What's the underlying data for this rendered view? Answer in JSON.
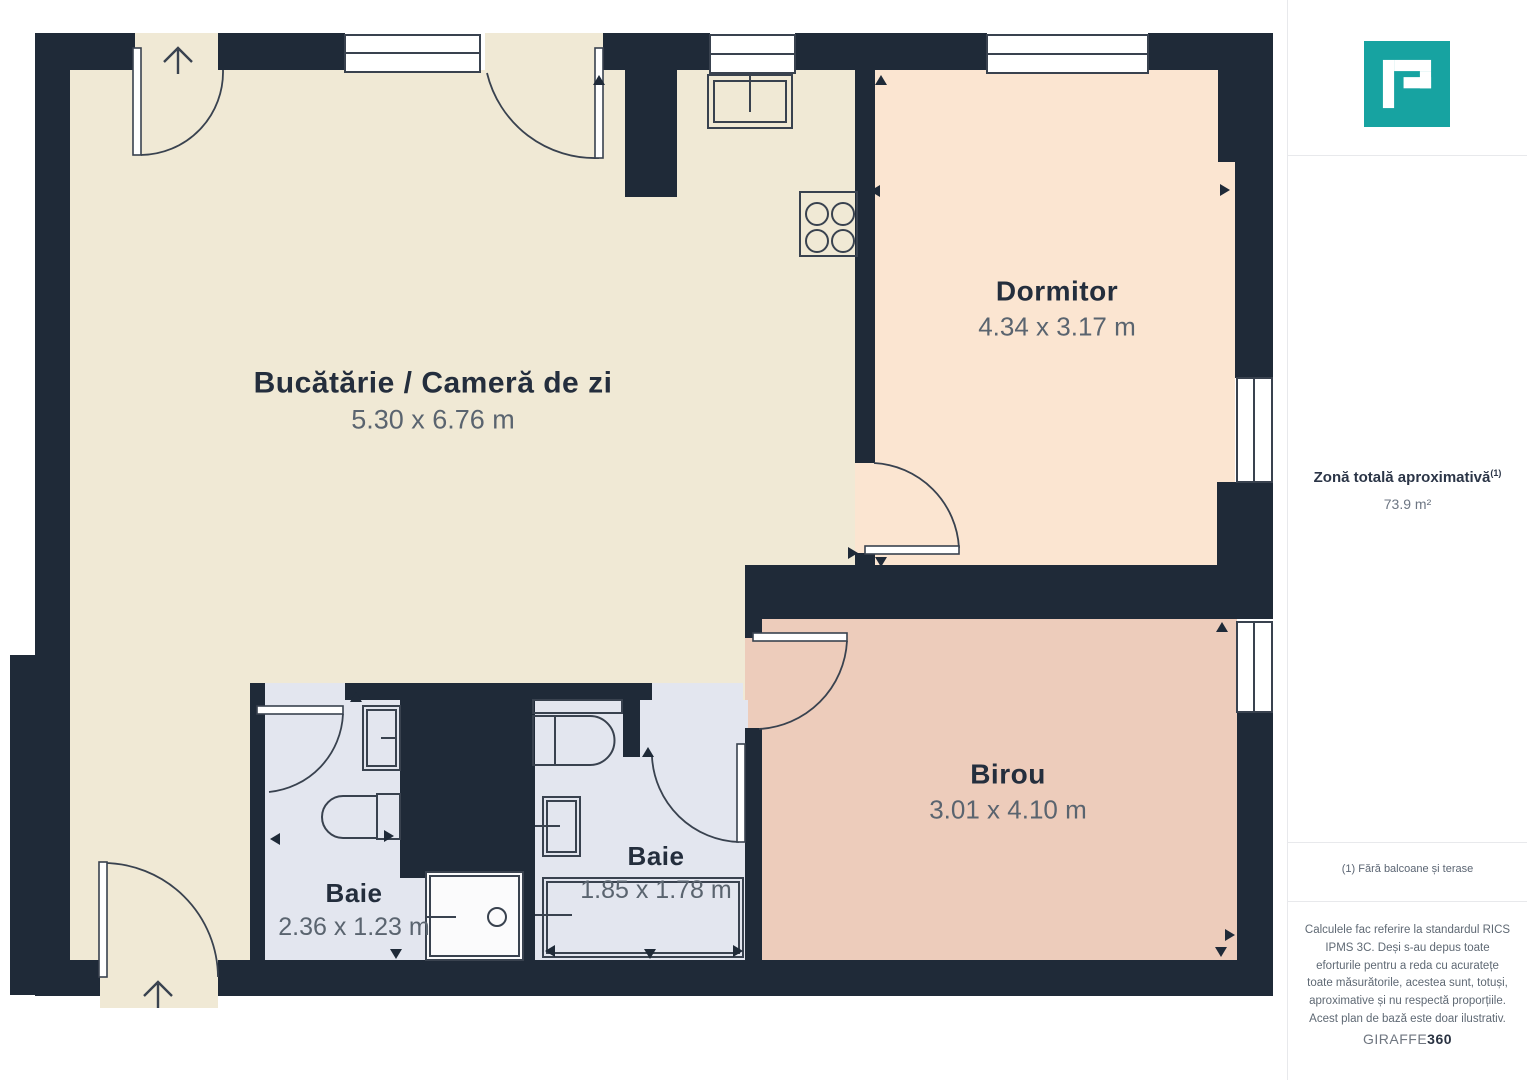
{
  "plan": {
    "rooms": [
      {
        "id": "kitchen-living",
        "name": "Bucătărie / Cameră de zi",
        "dims": "5.30 x 6.76 m"
      },
      {
        "id": "bedroom",
        "name": "Dormitor",
        "dims": "4.34 x 3.17 m"
      },
      {
        "id": "office",
        "name": "Birou",
        "dims": "3.01 x 4.10 m"
      },
      {
        "id": "bathroom-1",
        "name": "Baie",
        "dims": "2.36 x 1.23 m"
      },
      {
        "id": "bathroom-2",
        "name": "Baie",
        "dims": "1.85 x 1.78 m"
      }
    ]
  },
  "sidebar": {
    "area": {
      "title": "Zonă totală aproximativă",
      "footnote_ref": "(1)",
      "value": "73.9 m²"
    },
    "footnote": "(1) Fără balcoane și terase",
    "disclaimer": "Calculele fac referire la standardul RICS IPMS 3C. Deși s-au depus toate eforturile pentru a reda cu acuratețe toate măsurătorile, acestea sunt, totuși, aproximative și nu respectă proporțiile. Acest plan de bază este doar ilustrativ.",
    "brand": {
      "name": "GIRAFFE",
      "suffix": "360"
    }
  },
  "colors": {
    "wall": "#1f2a38",
    "kitchen": "#f0e9d5",
    "bedroom": "#fbe5d1",
    "office": "#edccbb",
    "bath": "#e3e6ef",
    "accent": "#17a3a1",
    "ink": "#242e3d",
    "dim": "#5a646f"
  }
}
